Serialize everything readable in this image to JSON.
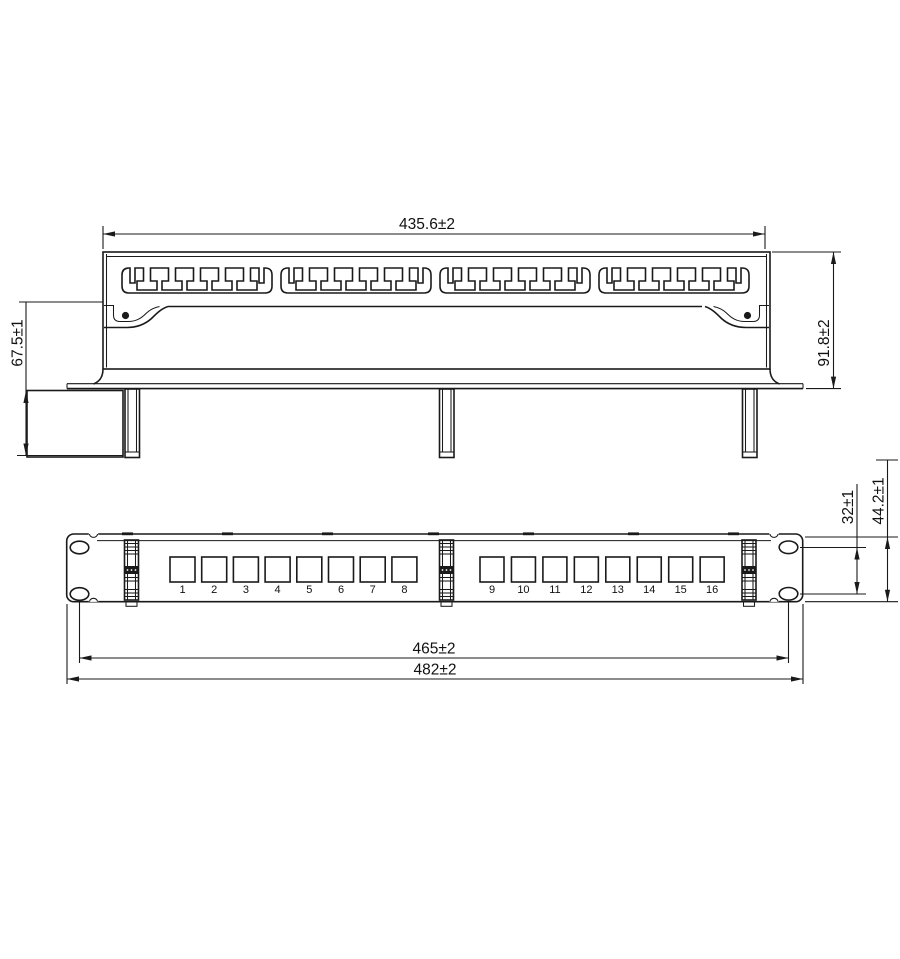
{
  "meta": {
    "background": "#ffffff",
    "line_color": "#1a1a1a"
  },
  "top_view": {
    "dims": {
      "width": "435.6±2",
      "height": "91.8±2",
      "depth": "67.5±1"
    }
  },
  "front_view": {
    "dims": {
      "hole_span": "465±2",
      "overall_width": "482±2",
      "hole_pitch": "32±1",
      "panel_height": "44.2±1"
    },
    "ports_left": [
      "1",
      "2",
      "3",
      "4",
      "5",
      "6",
      "7",
      "8"
    ],
    "ports_right": [
      "9",
      "10",
      "11",
      "12",
      "13",
      "14",
      "15",
      "16"
    ]
  }
}
